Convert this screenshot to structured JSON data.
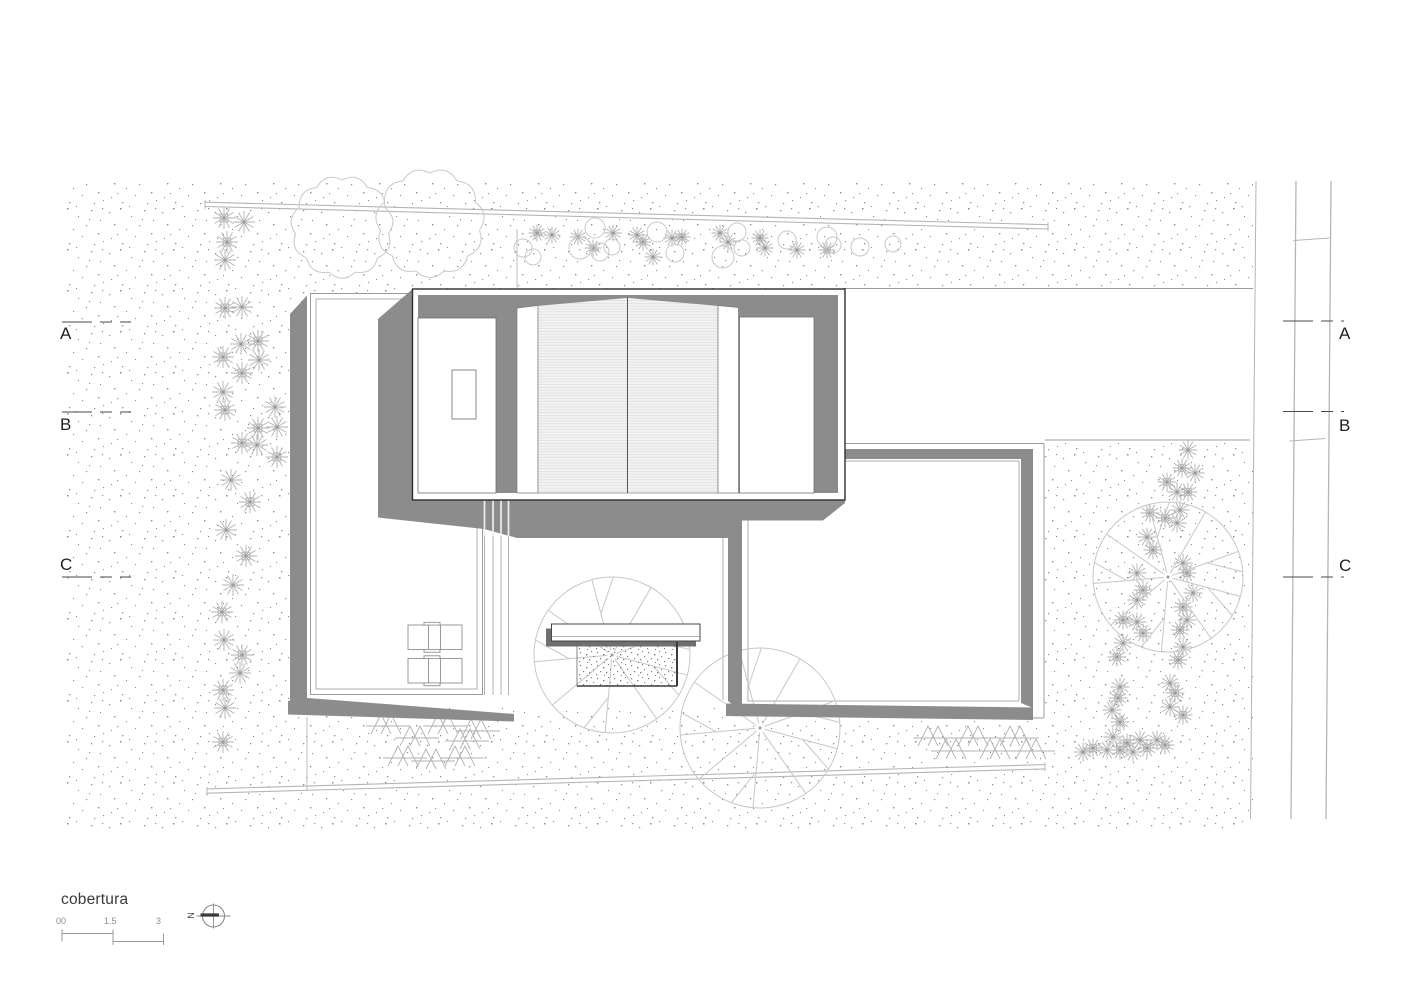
{
  "sheet": {
    "title": "cobertura"
  },
  "scale_bar": {
    "labels": [
      "00",
      "1.5",
      "3"
    ]
  },
  "north_indicator": {
    "label": "N"
  },
  "section_markers": [
    {
      "label": "A"
    },
    {
      "label": "B"
    },
    {
      "label": "C"
    }
  ],
  "colors": {
    "shadow": "#8c8c8c",
    "line_dark": "#2e2e2e",
    "line_light": "#9c9c9c",
    "terrain_line": "#b5b5b5",
    "stipple_dot": "#8d8d8d",
    "hatch_bg": "#f3f3f3",
    "hatch_line": "#dedede",
    "text": "#2b2b2b"
  }
}
